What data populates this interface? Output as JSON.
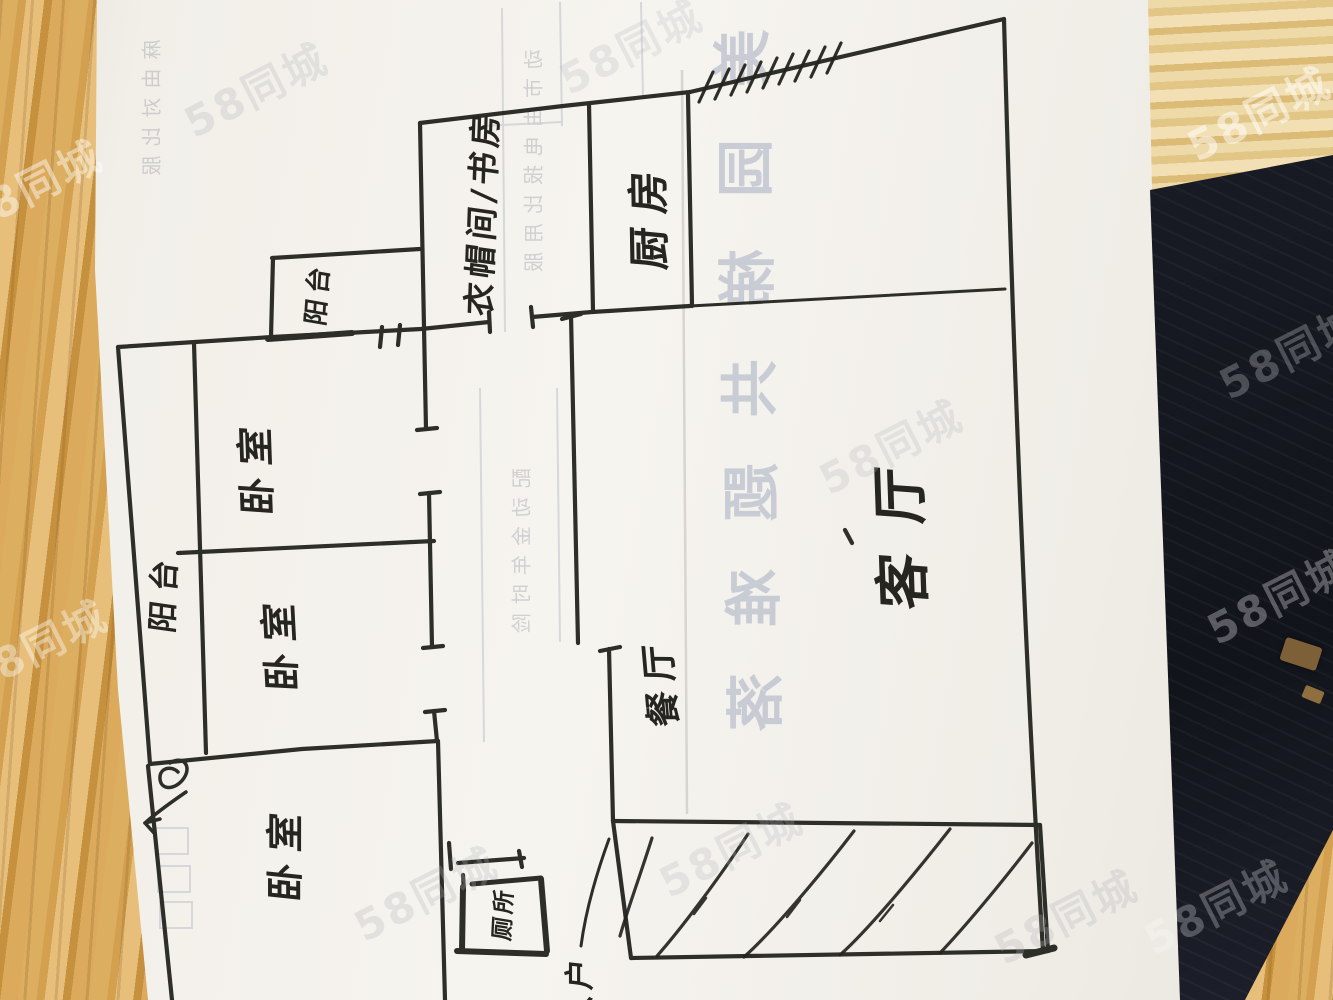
{
  "watermark": {
    "text": "58同城"
  },
  "floorplan": {
    "labels": [
      {
        "id": "storage-study",
        "text": "衣帽间/书房"
      },
      {
        "id": "kitchen",
        "text": "厨房"
      },
      {
        "id": "bay-window",
        "text": "阳台"
      },
      {
        "id": "bedroom-1",
        "text": "卧室"
      },
      {
        "id": "balcony",
        "text": "阳台"
      },
      {
        "id": "bedroom-2",
        "text": "卧室"
      },
      {
        "id": "bedroom-3",
        "text": "卧室"
      },
      {
        "id": "toilet",
        "text": "厕所"
      },
      {
        "id": "living-room",
        "text": "客厅"
      },
      {
        "id": "dining",
        "text": "餐厅"
      },
      {
        "id": "entry",
        "text": "入户"
      }
    ]
  },
  "showthrough": {
    "big_chars": [
      "美",
      "园",
      "梯",
      "共",
      "题",
      "难",
      "落"
    ],
    "col_a": "动市由电报比用服",
    "col_b": "配动金年时险",
    "col_c": "麻由对比服"
  }
}
